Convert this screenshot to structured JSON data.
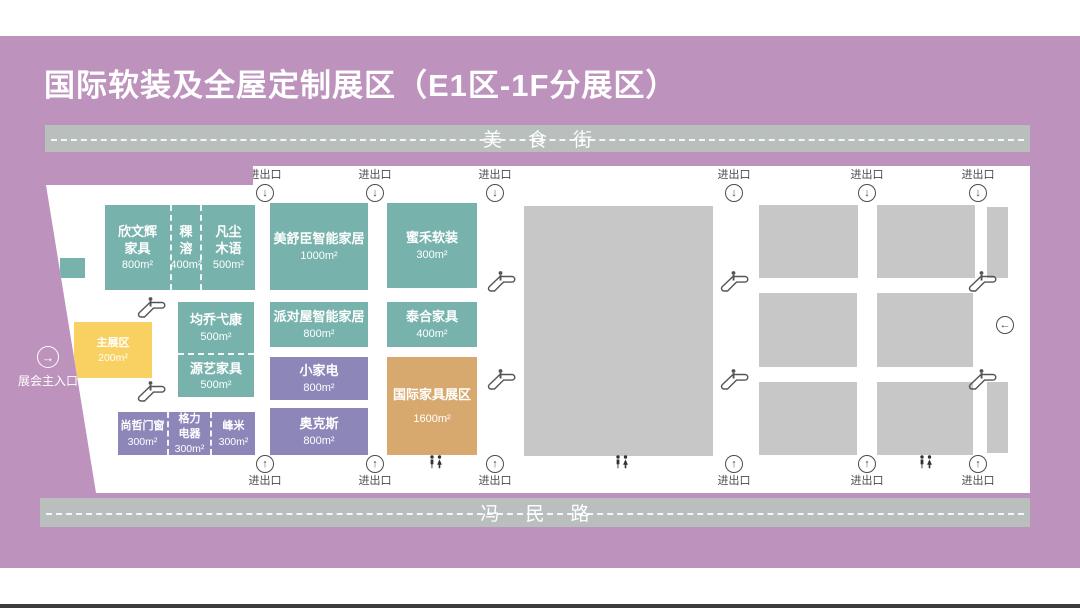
{
  "header": {
    "title": "国际软装及全屋定制展区（E1区-1F分展区）"
  },
  "roads": {
    "top": "美食街",
    "bottom": "冯民路"
  },
  "entrance": {
    "label": "展会主入口"
  },
  "labels": {
    "exit": "进出口"
  },
  "icons": {
    "down_arrow": "↓",
    "up_arrow": "↑",
    "right_arrow": "→",
    "left_arrow": "←",
    "escalator": "escalator-icon",
    "restroom": "restroom-icon"
  },
  "colors": {
    "background_purple": "#bd92bd",
    "road_bar_gray": "#b9bfbc",
    "booth_teal": "#77b3ac",
    "booth_violet": "#8d86b9",
    "booth_yellow": "#f9d162",
    "booth_tan": "#d8a96f",
    "vacant_gray": "#c7c7c7",
    "text_light": "#ffffff",
    "text_dark": "#4c4c4c"
  },
  "booths": [
    {
      "name": "欣文辉\n家具",
      "area": "800m²",
      "category": "teal"
    },
    {
      "name": "稞\n溶",
      "area": "400m²",
      "category": "teal"
    },
    {
      "name": "凡尘\n木语",
      "area": "500m²",
      "category": "teal"
    },
    {
      "name": "美舒臣智能家居",
      "area": "1000m²",
      "category": "teal"
    },
    {
      "name": "蜜禾软装",
      "area": "300m²",
      "category": "teal"
    },
    {
      "name": "均乔弋康",
      "area": "500m²",
      "category": "teal"
    },
    {
      "name": "源艺家具",
      "area": "500m²",
      "category": "teal"
    },
    {
      "name": "派对屋智能家居",
      "area": "800m²",
      "category": "teal"
    },
    {
      "name": "泰合家具",
      "area": "400m²",
      "category": "teal"
    },
    {
      "name": "小家电",
      "area": "800m²",
      "category": "violet"
    },
    {
      "name": "奥克斯",
      "area": "800m²",
      "category": "violet"
    },
    {
      "name": "国际家具展区",
      "area": "1600m²",
      "category": "tan"
    },
    {
      "name": "尚哲门窗",
      "area": "300m²",
      "category": "violet"
    },
    {
      "name": "格力\n电器",
      "area": "300m²",
      "category": "violet"
    },
    {
      "name": "峰米",
      "area": "300m²",
      "category": "violet"
    },
    {
      "name": "主展区",
      "area": "200m²",
      "category": "yellow"
    }
  ]
}
